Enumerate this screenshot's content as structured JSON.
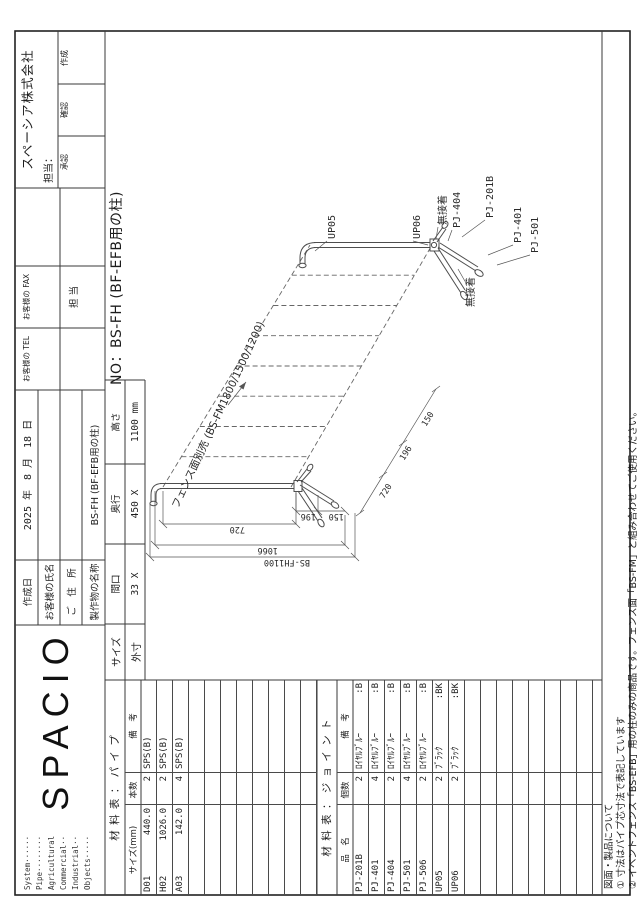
{
  "header": {
    "system_list": [
      "System······",
      "Pipe········",
      "Agricultural",
      "Commercial··",
      "Industrial··",
      "Objects·····"
    ],
    "logo": "SPACIO",
    "rows": [
      {
        "label": "作成日",
        "value": "2025 年　8 月　18 日"
      },
      {
        "label": "お客様の氏名",
        "value": ""
      },
      {
        "label": "ご　住　所",
        "value": ""
      },
      {
        "label": "製作物の名称",
        "value": "BS-FH (BF-EFB用の柱)"
      }
    ],
    "tel_label": "お客様の TEL",
    "fax_label": "お客様の FAX",
    "tanto_cell": "担 当",
    "company": "スペーシア株式会社",
    "company_tanto": "担当：",
    "approvals": [
      "承認",
      "確認",
      "作成"
    ]
  },
  "size_block": {
    "row1_label": "サイズ",
    "row2_label": "外寸",
    "cols": [
      {
        "h": "間口",
        "v": "33 X"
      },
      {
        "h": "奥行",
        "v": "450 X"
      },
      {
        "h": "高さ",
        "v": "1100 mm"
      }
    ]
  },
  "drawing_no": "NO：BS-FH (BF-EFB用の柱)",
  "pipe_table": {
    "title": "材 料 表 ： パ イ プ",
    "headers": [
      "サイズ(mm)",
      "本数",
      "備　考"
    ],
    "rows": [
      {
        "code": "D01",
        "size": "440.0",
        "qty": "2",
        "note": "SPS(B)",
        "note2": ""
      },
      {
        "code": "H02",
        "size": "1026.0",
        "qty": "2",
        "note": "SPS(B)",
        "note2": ""
      },
      {
        "code": "A03",
        "size": "142.0",
        "qty": "4",
        "note": "SPS(B)",
        "note2": ""
      }
    ],
    "empty_rows": 8
  },
  "joint_table": {
    "title": "材 料 表 ： ジ ョ イ ン ト",
    "headers": [
      "品　名",
      "個数",
      "備　考"
    ],
    "rows": [
      {
        "code": "PJ-201B",
        "qty": "2",
        "note": "ﾛｲﾔﾙﾌﾞﾙｰ",
        "note2": ":B"
      },
      {
        "code": "PJ-401",
        "qty": "4",
        "note": "ﾛｲﾔﾙﾌﾞﾙｰ",
        "note2": ":B"
      },
      {
        "code": "PJ-404",
        "qty": "2",
        "note": "ﾛｲﾔﾙﾌﾞﾙｰ",
        "note2": ":B"
      },
      {
        "code": "PJ-501",
        "qty": "4",
        "note": "ﾛｲﾔﾙﾌﾞﾙｰ",
        "note2": ":B"
      },
      {
        "code": "PJ-506",
        "qty": "2",
        "note": "ﾛｲﾔﾙﾌﾞﾙｰ",
        "note2": ":B"
      },
      {
        "code": "UP05",
        "qty": "2",
        "note": "ﾌﾞﾗｯｸ",
        "note2": ":BK"
      },
      {
        "code": "UP06",
        "qty": "2",
        "note": "ﾌﾞﾗｯｸ",
        "note2": ":BK"
      }
    ],
    "empty_rows": 9
  },
  "drawing": {
    "labels": {
      "up05": "UP05",
      "up06": "UP06",
      "glue1": "無接着",
      "pj404": "PJ-404",
      "pj201b": "PJ-201B",
      "glue2": "無接着",
      "pj401": "PJ-401",
      "pj501": "PJ-501"
    },
    "fence_note": "フェンス面別売 (BS-FM1800/1500/1200)",
    "dims": {
      "d150": "150",
      "d196": "196",
      "d720": "720",
      "d1066": "1066",
      "d_height": "BS-FH1100"
    }
  },
  "notes": {
    "title": "図面・製品について",
    "items": [
      "① 寸法はパイプ芯寸法で表記しています",
      "② イベントフェンス「BS-EFB」用の柱のみの商品です。フェンス面「BS-FM」と組み合わせてご使用ください。"
    ]
  }
}
